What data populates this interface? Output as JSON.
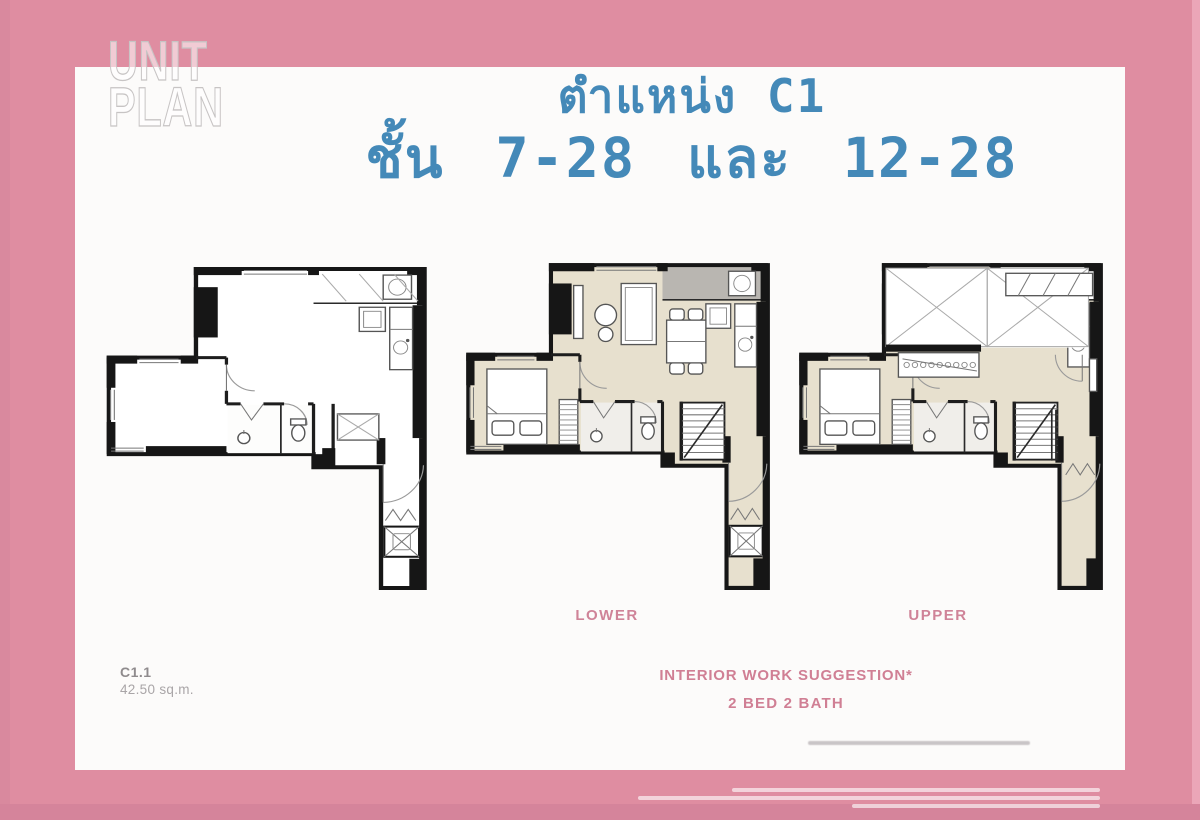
{
  "watermark": {
    "line1": "UNIT",
    "line2": "PLAN"
  },
  "title": {
    "line1": "ตำแหน่ง C1",
    "line2": "ชั้น 7-28 และ 12-28"
  },
  "plans": {
    "bare_name": "unit-shell-plan",
    "lower_label": "LOWER",
    "upper_label": "UPPER"
  },
  "footer": {
    "unit_code": "C1.1",
    "unit_area": "42.50 sq.m.",
    "suggestion_line1": "INTERIOR WORK SUGGESTION*",
    "suggestion_line2": "2 BED 2 BATH"
  },
  "colors": {
    "frame_pink": "#df8da1",
    "frame_edge_dark": "#d5849b",
    "sheet_white": "#fcfbfa",
    "title_blue": "#4489b8",
    "label_pink": "#cf8398",
    "floor_beige": "#e7e0ce",
    "balcony_gray": "#b9b6b1",
    "wall_black": "#161616"
  }
}
